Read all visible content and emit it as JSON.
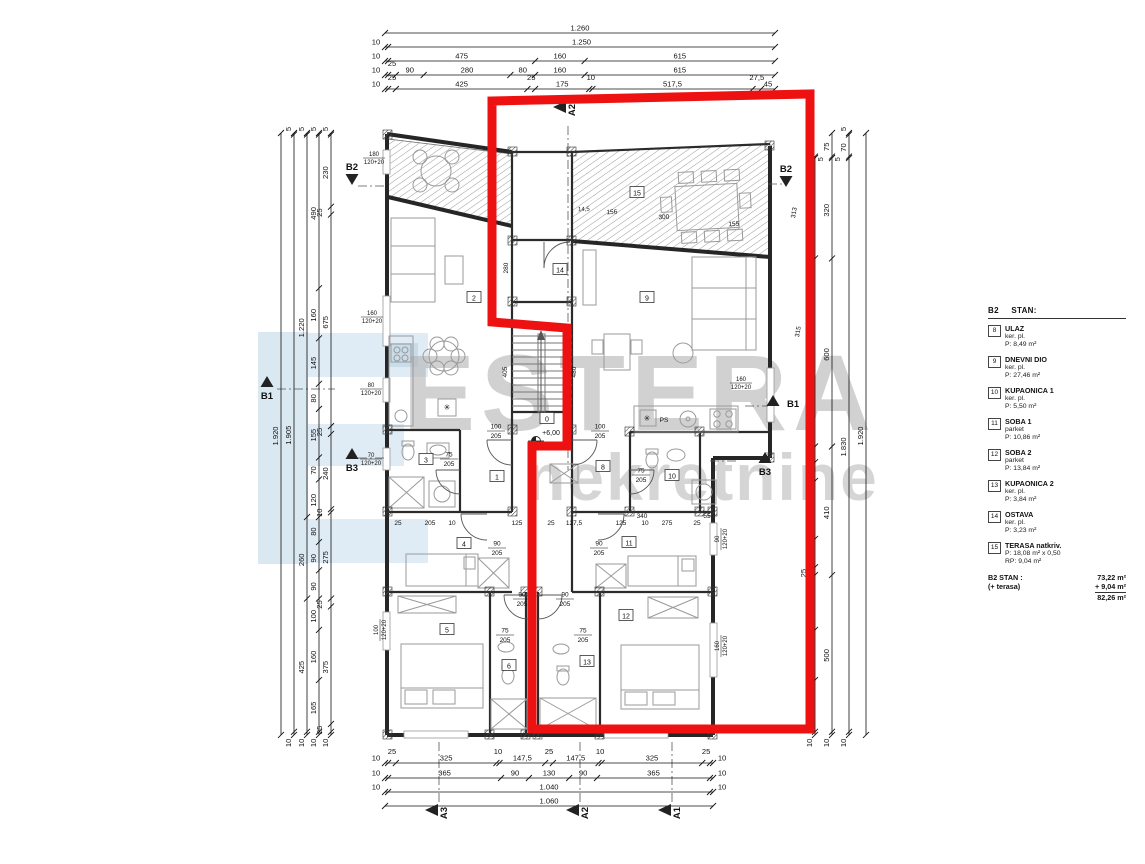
{
  "watermark": {
    "line1": "ESTERA",
    "line2": "nekretnine"
  },
  "legend": {
    "header_code": "B2",
    "header_label": "STAN:",
    "items": [
      {
        "num": "8",
        "name": "ULAZ",
        "floor": "ker. pl.",
        "area": "P: 8,49 m²"
      },
      {
        "num": "9",
        "name": "DNEVNI DIO",
        "floor": "ker. pl.",
        "area": "P: 27,46 m²"
      },
      {
        "num": "10",
        "name": "KUPAONICA 1",
        "floor": "ker. pl.",
        "area": "P: 5,50 m²"
      },
      {
        "num": "11",
        "name": "SOBA 1",
        "floor": "parket",
        "area": "P: 10,86 m²"
      },
      {
        "num": "12",
        "name": "SOBA 2",
        "floor": "parket",
        "area": "P: 13,84 m²"
      },
      {
        "num": "13",
        "name": "KUPAONICA 2",
        "floor": "ker. pl.",
        "area": "P: 3,84 m²"
      },
      {
        "num": "14",
        "name": "OSTAVA",
        "floor": "ker. pl.",
        "area": "P: 3,23 m²"
      },
      {
        "num": "15",
        "name": "TERASA natkriv.",
        "floor": "",
        "area": "P: 18,08 m² x 0,50",
        "area2": "RP: 9,04 m²"
      }
    ],
    "totals": {
      "label": "B2  STAN :",
      "value": "73,22 m²",
      "plus_label": "(+ terasa)",
      "plus_value": "+ 9,04 m²",
      "sum": "82,26 m²"
    }
  },
  "dims": {
    "top": [
      {
        "y": 33,
        "values": [
          "1.260"
        ]
      },
      {
        "y": 47,
        "values": [
          "10",
          "1.250"
        ]
      },
      {
        "y": 61,
        "values": [
          "10",
          "475",
          "160",
          "615"
        ]
      },
      {
        "y": 75,
        "values": [
          "10",
          "25",
          "90",
          "280",
          "80",
          "160",
          "615"
        ]
      },
      {
        "y": 89,
        "values": [
          "10",
          "25",
          "425",
          "25",
          "175",
          "10",
          "517,5",
          "27,5",
          "45"
        ]
      }
    ],
    "bottom": [
      {
        "y": 763,
        "values": [
          "10",
          "25",
          "325",
          "10",
          "147,5",
          "25",
          "147,5",
          "10",
          "325",
          "25",
          "10"
        ]
      },
      {
        "y": 778,
        "values": [
          "10",
          "365",
          "90",
          "130",
          "90",
          "365",
          "10"
        ]
      },
      {
        "y": 792,
        "values": [
          "10",
          "1.040",
          "10"
        ]
      },
      {
        "y": 806,
        "values": [
          "1.060"
        ]
      }
    ],
    "left": [
      {
        "x": 281,
        "values": [
          "1.920"
        ]
      },
      {
        "x": 294,
        "values": [
          "5",
          "1.905",
          "10"
        ]
      },
      {
        "x": 307,
        "values": [
          "5",
          "1.220",
          "260",
          "425",
          "10"
        ]
      },
      {
        "x": 319,
        "values": [
          "5",
          "490",
          "160",
          "145",
          "80",
          "155",
          "70",
          "120",
          "80",
          "90",
          "90",
          "100",
          "160",
          "165",
          "10"
        ]
      },
      {
        "x": 331,
        "values": [
          "5",
          "230",
          "25",
          "675",
          "25",
          "240",
          "10",
          "275",
          "25",
          "375",
          "25",
          "10"
        ]
      }
    ],
    "right": [
      {
        "x": 815,
        "start": "75",
        "values": [
          "5",
          "320",
          "600",
          "50",
          "60",
          "185",
          "90",
          "25",
          "175",
          "160",
          "165",
          "10"
        ]
      },
      {
        "x": 832,
        "values": [
          "75",
          "5",
          "320",
          "600",
          "410",
          "500",
          "10"
        ]
      },
      {
        "x": 849,
        "values": [
          "5",
          "70",
          "5",
          "1.830",
          "10"
        ]
      },
      {
        "x": 866,
        "values": [
          "1.920"
        ]
      }
    ]
  },
  "markers": [
    {
      "label": "A2",
      "x": 553,
      "y": 107,
      "type": "left"
    },
    {
      "label": "A3",
      "x": 425,
      "y": 810,
      "type": "left"
    },
    {
      "label": "A2",
      "x": 566,
      "y": 810,
      "type": "left"
    },
    {
      "label": "A1",
      "x": 658,
      "y": 810,
      "type": "left"
    },
    {
      "label": "B2",
      "x": 352,
      "y": 173,
      "type": "down"
    },
    {
      "label": "B2",
      "x": 786,
      "y": 175,
      "type": "down"
    },
    {
      "label": "B1",
      "x": 267,
      "y": 387,
      "type": "up"
    },
    {
      "label": "B1",
      "x": 789,
      "y": 404,
      "type": "up-right"
    },
    {
      "label": "B3",
      "x": 352,
      "y": 459,
      "type": "up"
    },
    {
      "label": "B3",
      "x": 765,
      "y": 463,
      "type": "up"
    }
  ],
  "room_labels": [
    {
      "n": "0",
      "x": 547,
      "y": 419
    },
    {
      "n": "1",
      "x": 497,
      "y": 477
    },
    {
      "n": "2",
      "x": 474,
      "y": 298
    },
    {
      "n": "3",
      "x": 426,
      "y": 460
    },
    {
      "n": "4",
      "x": 464,
      "y": 544
    },
    {
      "n": "5",
      "x": 447,
      "y": 630
    },
    {
      "n": "6",
      "x": 509,
      "y": 666
    },
    {
      "n": "8",
      "x": 603,
      "y": 467
    },
    {
      "n": "9",
      "x": 647,
      "y": 298
    },
    {
      "n": "10",
      "x": 672,
      "y": 476
    },
    {
      "n": "11",
      "x": 629,
      "y": 543
    },
    {
      "n": "12",
      "x": 626,
      "y": 616
    },
    {
      "n": "13",
      "x": 587,
      "y": 662
    },
    {
      "n": "14",
      "x": 560,
      "y": 270
    },
    {
      "n": "15",
      "x": 637,
      "y": 193
    }
  ],
  "door_labels": [
    {
      "w": "100",
      "h": "205",
      "x": 496,
      "y": 430
    },
    {
      "w": "100",
      "h": "205",
      "x": 600,
      "y": 430
    },
    {
      "w": "75",
      "h": "205",
      "x": 449,
      "y": 458
    },
    {
      "w": "75",
      "h": "205",
      "x": 641,
      "y": 474
    },
    {
      "w": "75",
      "h": "205",
      "x": 505,
      "y": 634
    },
    {
      "w": "75",
      "h": "205",
      "x": 583,
      "y": 634
    },
    {
      "w": "90",
      "h": "205",
      "x": 522,
      "y": 598
    },
    {
      "w": "90",
      "h": "205",
      "x": 565,
      "y": 598
    },
    {
      "w": "90",
      "h": "205",
      "x": 497,
      "y": 547
    },
    {
      "w": "90",
      "h": "205",
      "x": 599,
      "y": 547
    }
  ],
  "window_labels": [
    {
      "t": "180",
      "b": "120+20",
      "x": 374,
      "y": 157,
      "rot": 0
    },
    {
      "t": "160",
      "b": "120+20",
      "x": 372,
      "y": 316,
      "rot": 0
    },
    {
      "t": "80",
      "b": "120+20",
      "x": 371,
      "y": 388,
      "rot": 0
    },
    {
      "t": "70",
      "b": "120+20",
      "x": 371,
      "y": 458,
      "rot": 0
    },
    {
      "t": "100",
      "b": "120+20",
      "x": 379,
      "y": 630,
      "rot": -90
    },
    {
      "t": "90",
      "b": "120+20",
      "x": 720,
      "y": 539,
      "rot": -90
    },
    {
      "t": "160",
      "b": "120+20",
      "x": 720,
      "y": 646,
      "rot": -90
    },
    {
      "t": "160",
      "b": "120+20",
      "x": 741,
      "y": 382,
      "rot": 0
    }
  ],
  "small_labels": [
    {
      "t": "+6,00",
      "x": 551,
      "y": 435,
      "fs": 7
    },
    {
      "t": "PS",
      "x": 664,
      "y": 422,
      "fs": 6.5
    },
    {
      "t": "✳",
      "x": 647,
      "y": 421,
      "fs": 8
    },
    {
      "t": "✳",
      "x": 447,
      "y": 410,
      "fs": 8
    },
    {
      "t": "14,5",
      "x": 584,
      "y": 211,
      "fs": 6,
      "r": -3
    },
    {
      "t": "156",
      "x": 612,
      "y": 214,
      "fs": 6.5,
      "r": -3
    },
    {
      "t": "300",
      "x": 664,
      "y": 219,
      "fs": 6.5,
      "r": -3
    },
    {
      "t": "155",
      "x": 734,
      "y": 226,
      "fs": 6.5,
      "r": -3
    },
    {
      "t": "313",
      "x": 796,
      "y": 213,
      "fs": 6.5,
      "r": -80
    },
    {
      "t": "315",
      "x": 800,
      "y": 332,
      "fs": 6.5,
      "r": -80
    },
    {
      "t": "280",
      "x": 508,
      "y": 268,
      "fs": 6.5,
      "r": -90
    },
    {
      "t": "405",
      "x": 507,
      "y": 372,
      "fs": 6.5,
      "r": -90
    },
    {
      "t": "480",
      "x": 576,
      "y": 372,
      "fs": 6.5,
      "r": -90
    },
    {
      "t": "25",
      "x": 398,
      "y": 525,
      "fs": 6.5
    },
    {
      "t": "205",
      "x": 430,
      "y": 525,
      "fs": 6.5
    },
    {
      "t": "10",
      "x": 452,
      "y": 525,
      "fs": 6.5
    },
    {
      "t": "125",
      "x": 517,
      "y": 525,
      "fs": 6.5
    },
    {
      "t": "25",
      "x": 551,
      "y": 525,
      "fs": 6.5
    },
    {
      "t": "127,5",
      "x": 574,
      "y": 525,
      "fs": 6.5
    },
    {
      "t": "125",
      "x": 621,
      "y": 525,
      "fs": 6.5
    },
    {
      "t": "10",
      "x": 645,
      "y": 525,
      "fs": 6.5
    },
    {
      "t": "275",
      "x": 667,
      "y": 525,
      "fs": 6.5
    },
    {
      "t": "25",
      "x": 697,
      "y": 525,
      "fs": 6.5
    },
    {
      "t": "340",
      "x": 642,
      "y": 518,
      "fs": 6.5
    },
    {
      "t": "55",
      "x": 707,
      "y": 518,
      "fs": 6.5
    }
  ],
  "accent_colors": {
    "outline_red": "#ee1111",
    "watermark_gray": "#b3b3b3",
    "watermark_blue": "#bcd7e8"
  }
}
